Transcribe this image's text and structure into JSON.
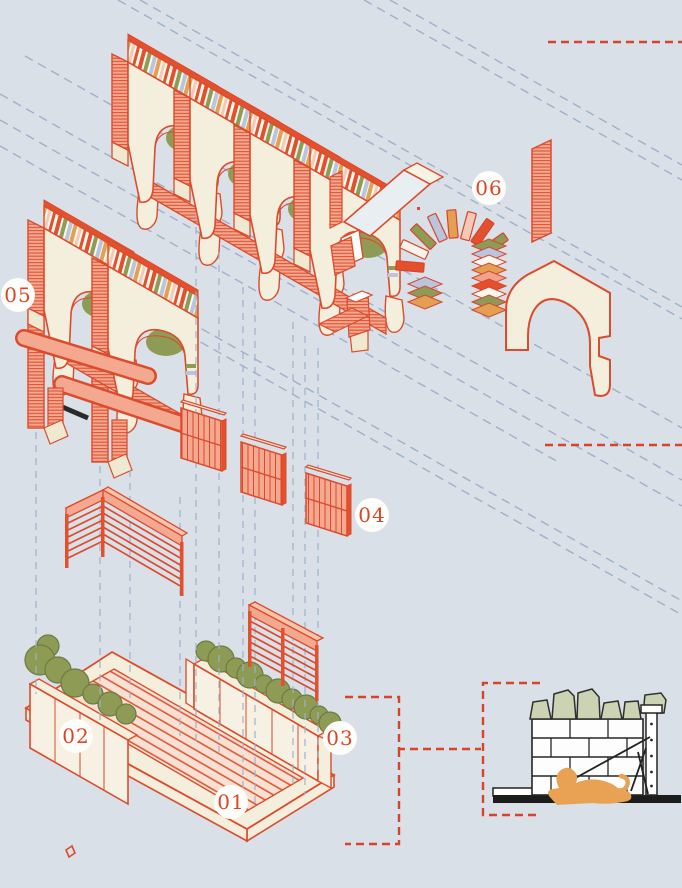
{
  "diagram": {
    "kind": "exploded-axonometric-architecture",
    "callouts": {
      "c1": "01",
      "c2": "02",
      "c3": "03",
      "c4": "04",
      "c5": "05",
      "c6": "06"
    },
    "palette": {
      "background": "#d9e0e8",
      "accent_red": "#dc4b2c",
      "accent_red_fill": "#e2502e",
      "cream": "#f4eedc",
      "salmon": "#f3a88f",
      "guide_blue": "#95a8c5",
      "olive_green": "#8d9b55",
      "book_blue": "#b9c4df",
      "book_orange": "#e3a052",
      "book_pink": "#f6c9b6",
      "dog_orange": "#e9a254",
      "stone_green": "#ccd3b2",
      "ink": "#222222",
      "label_red": "#d9472b"
    }
  }
}
